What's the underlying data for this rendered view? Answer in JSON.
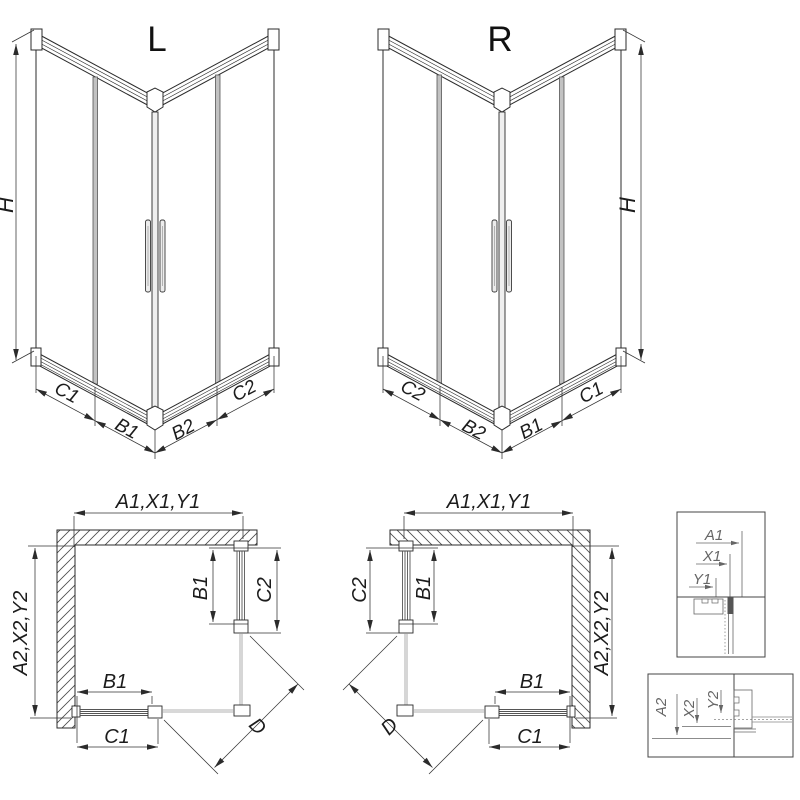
{
  "colors": {
    "line": "#2b2b2b",
    "dim_line": "#333333",
    "glass_gray": "#8c8c8c",
    "stile_fill": "#c2c2c2",
    "detail_gray": "#666666",
    "background": "#ffffff"
  },
  "views": {
    "iso_left": {
      "title": "L",
      "height_label": "H",
      "dims": {
        "c1": "C1",
        "b1": "B1",
        "b2": "B2",
        "c2": "C2"
      }
    },
    "iso_right": {
      "title": "R",
      "height_label": "H",
      "dims": {
        "c2": "C2",
        "b2": "B2",
        "b1": "B1",
        "c1": "C1"
      }
    },
    "plan_left": {
      "top_dim": "A1,X1,Y1",
      "side_dim": "A2,X2,Y2",
      "door_width_dim": "B1",
      "door_overall_dim": "C2",
      "bottom_door_width_dim": "B1",
      "bottom_door_overall_dim": "C1",
      "diagonal_dim": "D"
    },
    "plan_right": {
      "top_dim": "A1,X1,Y1",
      "side_dim": "A2,X2,Y2",
      "door_width_dim": "B1",
      "door_overall_dim": "C2",
      "bottom_door_width_dim": "B1",
      "bottom_door_overall_dim": "C1",
      "diagonal_dim": "D"
    },
    "detail_top": {
      "dims": [
        "A1",
        "X1",
        "Y1"
      ]
    },
    "detail_bottom": {
      "dims": [
        "A2",
        "X2",
        "Y2"
      ]
    }
  }
}
